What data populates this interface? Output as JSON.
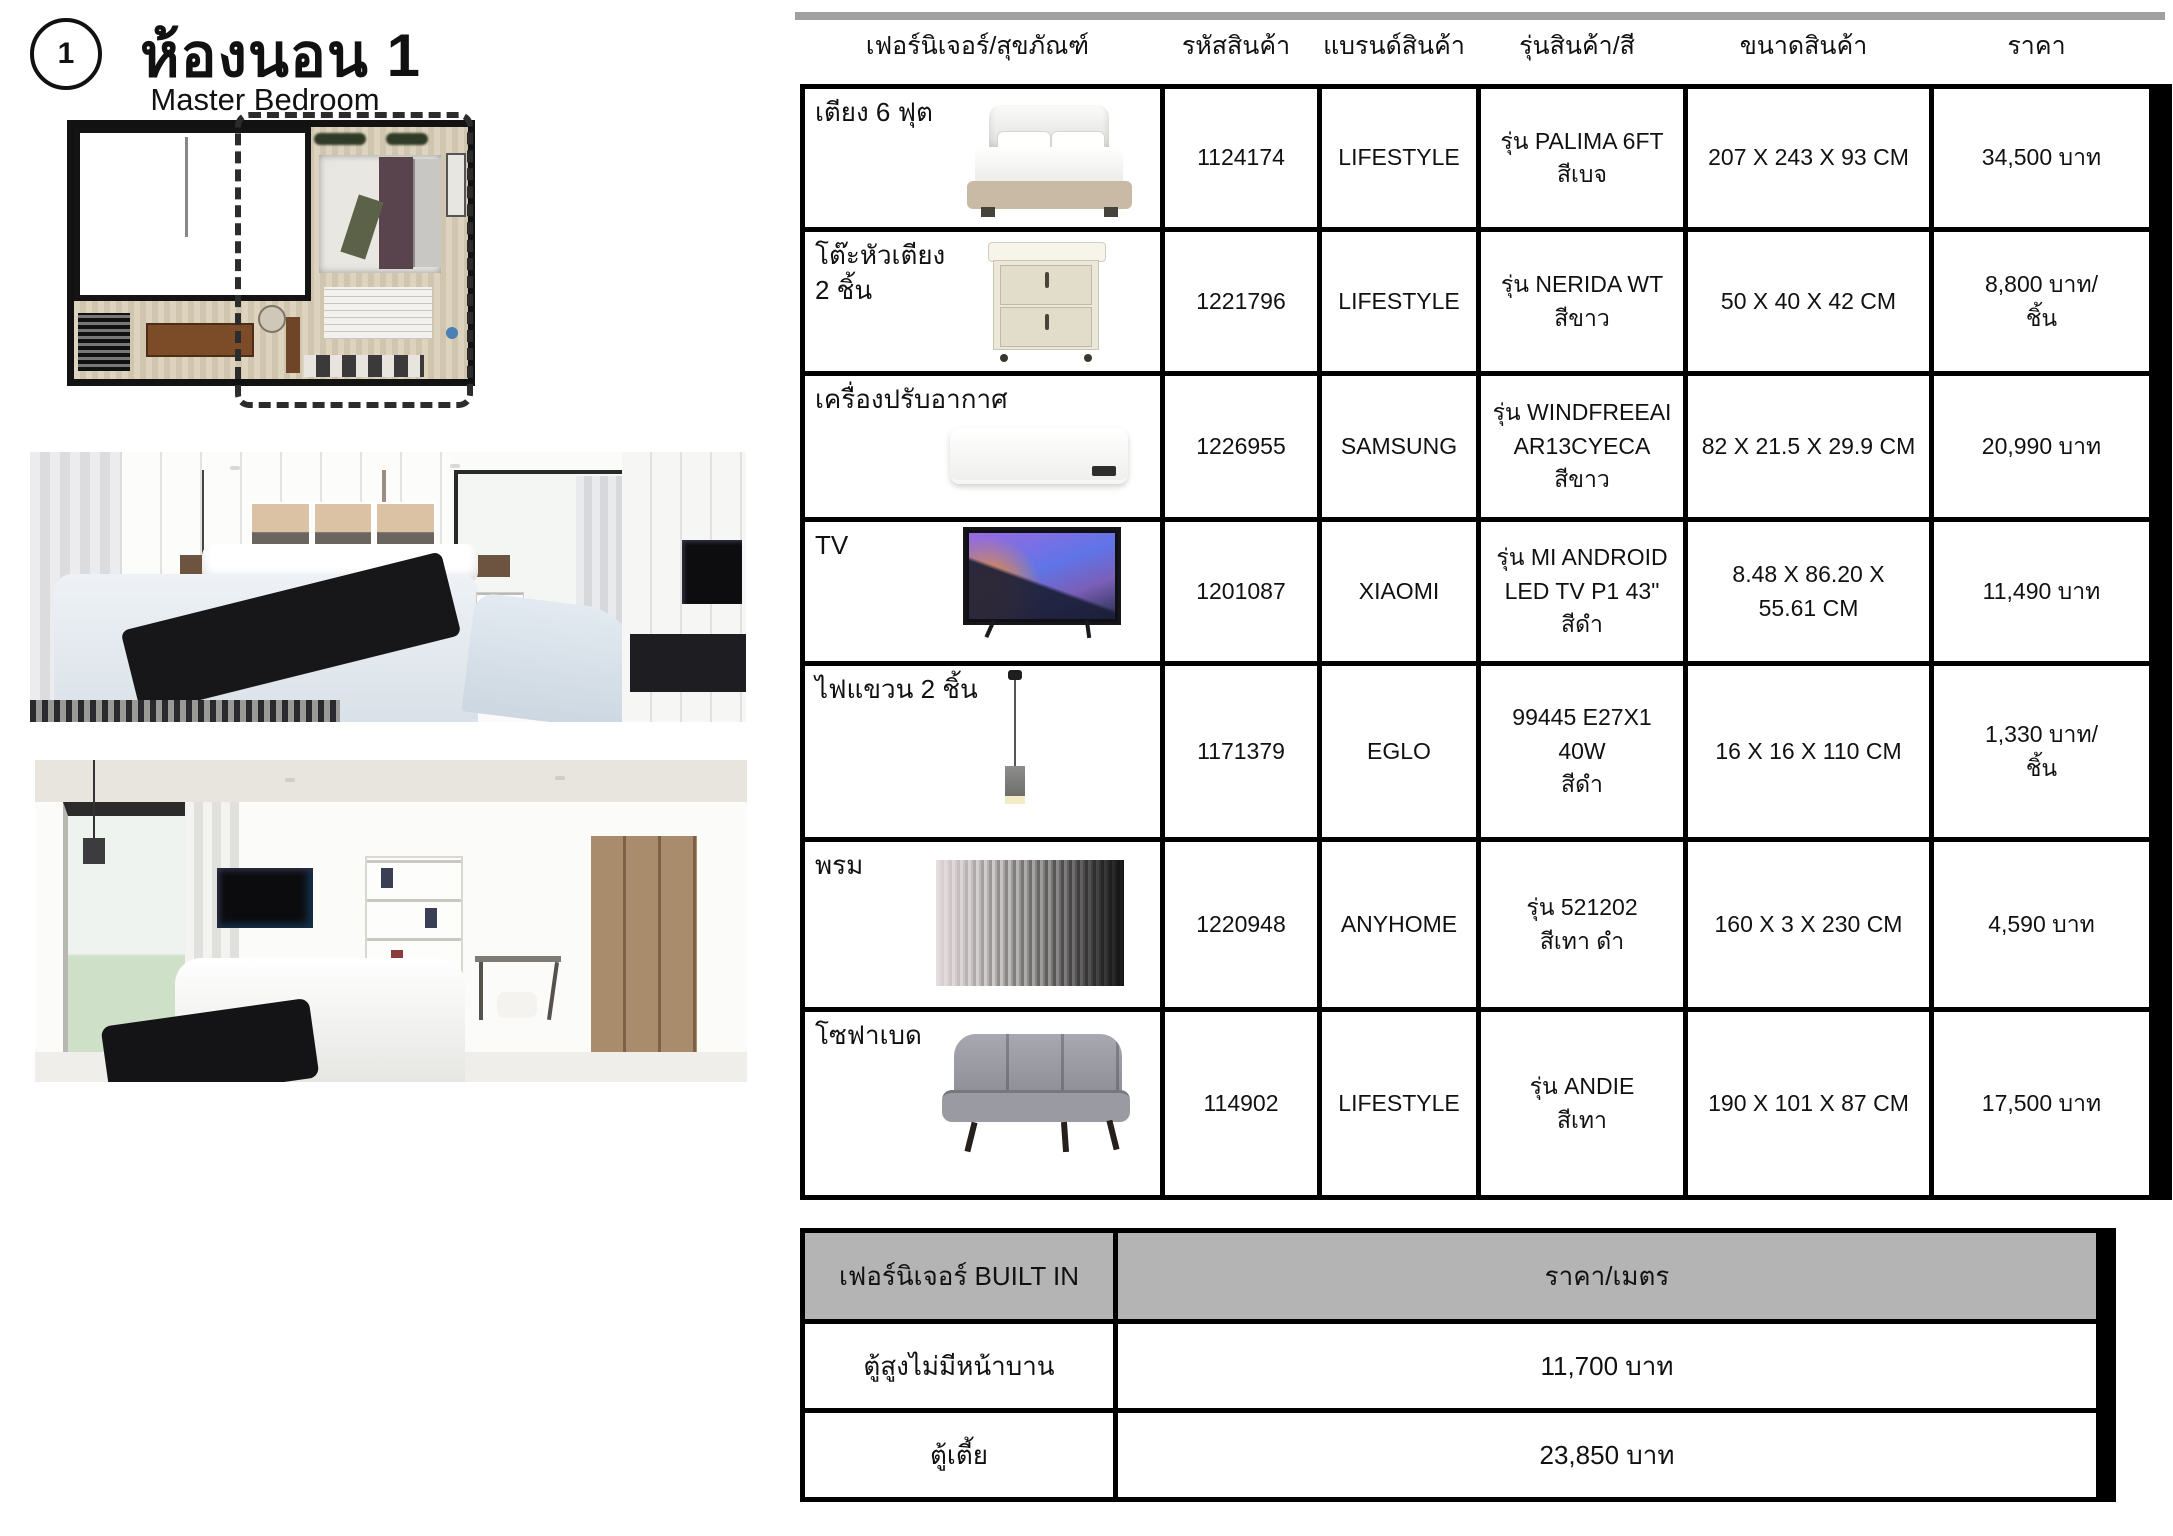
{
  "colors": {
    "table_border": "#000000",
    "builtin_header_bg": "#b4b4b4",
    "top_bar": "#a0a0a0"
  },
  "page": {
    "number": "1",
    "title": "ห้องนอน 1",
    "subtitle": "Master Bedroom"
  },
  "table": {
    "headers": {
      "furniture": "เฟอร์นิเจอร์/สุขภัณฑ์",
      "code": "รหัสสินค้า",
      "brand": "แบรนด์สินค้า",
      "model": "รุ่นสินค้า/สี",
      "size": "ขนาดสินค้า",
      "price": "ราคา"
    },
    "rows": [
      {
        "name": "เตียง 6 ฟุต",
        "image": "bed",
        "code": "1124174",
        "brand": "LIFESTYLE",
        "model": "รุ่น PALIMA 6FT\nสีเบจ",
        "size": "207 X 243 X 93 CM",
        "price": "34,500 บาท"
      },
      {
        "name": "โต๊ะหัวเตียง\n2 ชิ้น",
        "image": "nightstand",
        "code": "1221796",
        "brand": "LIFESTYLE",
        "model": "รุ่น NERIDA WT\nสีขาว",
        "size": "50 X 40 X 42 CM",
        "price": "8,800 บาท/\nชิ้น"
      },
      {
        "name": "เครื่องปรับอากาศ",
        "image": "air-conditioner",
        "code": "1226955",
        "brand": "SAMSUNG",
        "model": "รุ่น WINDFREEAI\nAR13CYECA\nสีขาว",
        "size": "82 X 21.5 X 29.9 CM",
        "price": "20,990 บาท"
      },
      {
        "name": "TV",
        "image": "tv",
        "code": "1201087",
        "brand": "XIAOMI",
        "model": "รุ่น MI ANDROID\nLED TV P1 43\"\nสีดำ",
        "size": "8.48 X 86.20 X\n55.61 CM",
        "price": "11,490 บาท"
      },
      {
        "name": "ไฟแขวน  2 ชิ้น",
        "image": "pendant-lamp",
        "code": "1171379",
        "brand": "EGLO",
        "model": "99445 E27X1\n40W\nสีดำ",
        "size": "16 X 16 X 110 CM",
        "price": "1,330 บาท/\nชิ้น"
      },
      {
        "name": "พรม",
        "image": "rug",
        "code": "1220948",
        "brand": "ANYHOME",
        "model": "รุ่น 521202\nสีเทา ดำ",
        "size": "160 X 3 X 230 CM",
        "price": "4,590 บาท"
      },
      {
        "name": "โซฟาเบด",
        "image": "sofa-bed",
        "code": "114902",
        "brand": "LIFESTYLE",
        "model": "รุ่น ANDIE\nสีเทา",
        "size": "190 X 101 X 87 CM",
        "price": "17,500 บาท"
      }
    ]
  },
  "builtin_table": {
    "header_left": "เฟอร์นิเจอร์ BUILT IN",
    "header_right": "ราคา/เมตร",
    "rows": [
      {
        "label": "ตู้สูงไม่มีหน้าบาน",
        "price": "11,700 บาท"
      },
      {
        "label": "ตู้เตี้ย",
        "price": "23,850 บาท"
      }
    ]
  }
}
